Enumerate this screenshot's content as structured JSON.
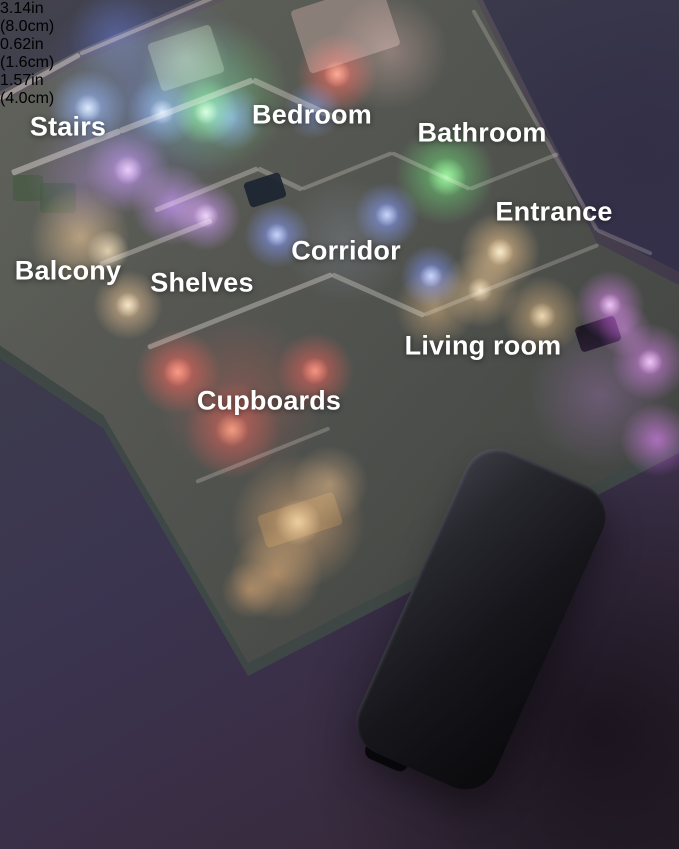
{
  "canvas": {
    "width": 679,
    "height": 849
  },
  "palette": {
    "background_top": "#42424d",
    "background_bottom": "#2c2430",
    "device_body": "#16161b",
    "light_bar_warm_white": "#fdf5da",
    "annotation_white": "#ffffff"
  },
  "floorplan": {
    "outline": [
      [
        -20,
        102
      ],
      [
        80,
        50
      ],
      [
        265,
        -30
      ],
      [
        468,
        -30
      ],
      [
        597,
        230
      ],
      [
        679,
        272
      ],
      [
        679,
        440
      ],
      [
        248,
        663
      ],
      [
        188,
        560
      ],
      [
        103,
        415
      ],
      [
        -20,
        332
      ]
    ],
    "rooms": [
      {
        "name": "stairs",
        "label": "Stairs",
        "x": 68,
        "y": 127,
        "light_color": "#5a8cff"
      },
      {
        "name": "bedroom",
        "label": "Bedroom",
        "x": 312,
        "y": 115,
        "light_color": "#3ae24e"
      },
      {
        "name": "bathroom",
        "label": "Bathroom",
        "x": 482,
        "y": 133,
        "light_color": "#35d045"
      },
      {
        "name": "entrance",
        "label": "Entrance",
        "x": 554,
        "y": 212,
        "light_color": "#f0b060"
      },
      {
        "name": "corridor",
        "label": "Corridor",
        "x": 346,
        "y": 251,
        "light_color": "#4a6aff"
      },
      {
        "name": "balcony",
        "label": "Balcony",
        "x": 68,
        "y": 271,
        "light_color": "#f0b068"
      },
      {
        "name": "shelves",
        "label": "Shelves",
        "x": 202,
        "y": 283,
        "light_color": "#b060ff"
      },
      {
        "name": "living_room",
        "label": "Living room",
        "x": 483,
        "y": 346,
        "light_color": "#d355f0"
      },
      {
        "name": "cupboards",
        "label": "Cupboards",
        "x": 269,
        "y": 401,
        "light_color": "#f01810"
      }
    ],
    "glows": [
      [
        150,
        92,
        115,
        "#2f55e0",
        0.4
      ],
      [
        88,
        108,
        40,
        "#5a8cff",
        0.75
      ],
      [
        88,
        108,
        14,
        "#cfe0ff",
        0.85
      ],
      [
        162,
        112,
        36,
        "#5a8cff",
        0.7
      ],
      [
        162,
        112,
        13,
        "#cfe0ff",
        0.8
      ],
      [
        232,
        118,
        34,
        "#4f7dff",
        0.65
      ],
      [
        115,
        35,
        48,
        "#3a5adf",
        0.35
      ],
      [
        313,
        110,
        30,
        "#4f7dff",
        0.55
      ],
      [
        213,
        95,
        80,
        "#2fd045",
        0.5
      ],
      [
        206,
        112,
        34,
        "#50f060",
        0.8
      ],
      [
        206,
        112,
        13,
        "#c0ffc0",
        0.85
      ],
      [
        185,
        60,
        45,
        "#b8e8b0",
        0.3
      ],
      [
        390,
        52,
        60,
        "#d8948e",
        0.4
      ],
      [
        337,
        74,
        42,
        "#ff2418",
        0.75
      ],
      [
        337,
        74,
        14,
        "#ff7a60",
        0.9
      ],
      [
        128,
        170,
        44,
        "#a855f7",
        0.75
      ],
      [
        128,
        170,
        15,
        "#e0b0ff",
        0.8
      ],
      [
        172,
        205,
        42,
        "#b060ff",
        0.75
      ],
      [
        206,
        216,
        36,
        "#c06bff",
        0.75
      ],
      [
        206,
        216,
        13,
        "#e8c0ff",
        0.8
      ],
      [
        85,
        178,
        60,
        "#8a4fd0",
        0.35
      ],
      [
        277,
        235,
        34,
        "#4a6aff",
        0.75
      ],
      [
        277,
        235,
        12,
        "#b8c8ff",
        0.8
      ],
      [
        387,
        215,
        34,
        "#4a6aff",
        0.75
      ],
      [
        387,
        215,
        12,
        "#b8c8ff",
        0.8
      ],
      [
        431,
        276,
        32,
        "#4a6aff",
        0.75
      ],
      [
        431,
        276,
        12,
        "#b8c8ff",
        0.8
      ],
      [
        345,
        240,
        65,
        "#8090c0",
        0.22
      ],
      [
        445,
        175,
        52,
        "#2ed03e",
        0.7
      ],
      [
        447,
        177,
        20,
        "#70ff70",
        0.85
      ],
      [
        500,
        252,
        42,
        "#f0b060",
        0.75
      ],
      [
        500,
        252,
        14,
        "#ffe2b0",
        0.85
      ],
      [
        480,
        290,
        40,
        "#f0b060",
        0.6
      ],
      [
        480,
        290,
        13,
        "#ffe2b0",
        0.75
      ],
      [
        542,
        316,
        42,
        "#e8a855",
        0.6
      ],
      [
        542,
        316,
        14,
        "#ffd9a0",
        0.75
      ],
      [
        435,
        308,
        42,
        "#e8a855",
        0.5
      ],
      [
        610,
        305,
        36,
        "#d355f0",
        0.7
      ],
      [
        610,
        305,
        12,
        "#f0b8ff",
        0.8
      ],
      [
        650,
        362,
        40,
        "#d355f0",
        0.7
      ],
      [
        650,
        362,
        13,
        "#f0b8ff",
        0.8
      ],
      [
        657,
        440,
        38,
        "#c94fe8",
        0.7
      ],
      [
        600,
        395,
        75,
        "#9a4ac0",
        0.32
      ],
      [
        625,
        330,
        28,
        "#e060ff",
        0.5
      ],
      [
        80,
        237,
        52,
        "#f0b068",
        0.6
      ],
      [
        108,
        251,
        22,
        "#ffd9a0",
        0.75
      ],
      [
        128,
        305,
        36,
        "#f0b068",
        0.7
      ],
      [
        128,
        305,
        13,
        "#ffe0b0",
        0.8
      ],
      [
        240,
        398,
        85,
        "#900c06",
        0.45
      ],
      [
        178,
        372,
        44,
        "#f01810",
        0.75
      ],
      [
        178,
        372,
        15,
        "#ff6a50",
        0.85
      ],
      [
        315,
        371,
        40,
        "#f01810",
        0.7
      ],
      [
        315,
        371,
        14,
        "#ff6a50",
        0.8
      ],
      [
        232,
        430,
        50,
        "#d01510",
        0.65
      ],
      [
        232,
        430,
        17,
        "#ff7a50",
        0.8
      ],
      [
        298,
        522,
        70,
        "#e89040",
        0.6
      ],
      [
        298,
        522,
        24,
        "#ffc080",
        0.7
      ],
      [
        276,
        574,
        48,
        "#e89040",
        0.55
      ],
      [
        330,
        484,
        40,
        "#f0a860",
        0.45
      ],
      [
        250,
        590,
        30,
        "#d88038",
        0.5
      ]
    ],
    "walls": [
      [
        0,
        96,
        80,
        52,
        5,
        0.5
      ],
      [
        80,
        52,
        262,
        -25,
        4,
        0.4
      ],
      [
        12,
        170,
        120,
        128,
        6,
        0.5
      ],
      [
        120,
        128,
        253,
        77,
        6,
        0.45
      ],
      [
        253,
        77,
        342,
        118,
        6,
        0.4
      ],
      [
        155,
        208,
        258,
        166,
        5,
        0.38
      ],
      [
        258,
        166,
        302,
        187,
        5,
        0.33
      ],
      [
        302,
        187,
        392,
        151,
        4,
        0.3
      ],
      [
        392,
        151,
        470,
        187,
        4,
        0.3
      ],
      [
        470,
        187,
        558,
        152,
        4,
        0.28
      ],
      [
        100,
        262,
        212,
        218,
        5,
        0.4
      ],
      [
        148,
        345,
        332,
        272,
        5,
        0.42
      ],
      [
        332,
        272,
        424,
        313,
        5,
        0.38
      ],
      [
        424,
        313,
        598,
        243,
        4,
        0.28
      ],
      [
        196,
        480,
        330,
        426,
        4,
        0.28
      ],
      [
        473,
        8,
        597,
        228,
        4,
        0.25
      ],
      [
        597,
        228,
        652,
        252,
        4,
        0.25
      ]
    ],
    "accents": [
      [
        265,
        190,
        38,
        26,
        -18,
        "#1b2330",
        0.9
      ],
      [
        598,
        334,
        42,
        26,
        -18,
        "#120d1a",
        0.85
      ],
      [
        345,
        28,
        95,
        66,
        -18,
        "#d8b4ae",
        0.4
      ],
      [
        186,
        58,
        66,
        50,
        -18,
        "#cfe4c4",
        0.3
      ],
      [
        58,
        198,
        36,
        30,
        0,
        "#3c5838",
        0.55
      ],
      [
        28,
        188,
        30,
        26,
        0,
        "#3c5838",
        0.5
      ],
      [
        300,
        520,
        80,
        34,
        -18,
        "#b88a58",
        0.35
      ]
    ]
  },
  "product": {
    "dimensions": {
      "height_in": "3.14in",
      "height_cm": "(8.0cm)",
      "depth_in": "0.62in",
      "depth_cm": "(1.6cm)",
      "width_in": "1.57in",
      "width_cm": "(4.0cm)"
    }
  }
}
